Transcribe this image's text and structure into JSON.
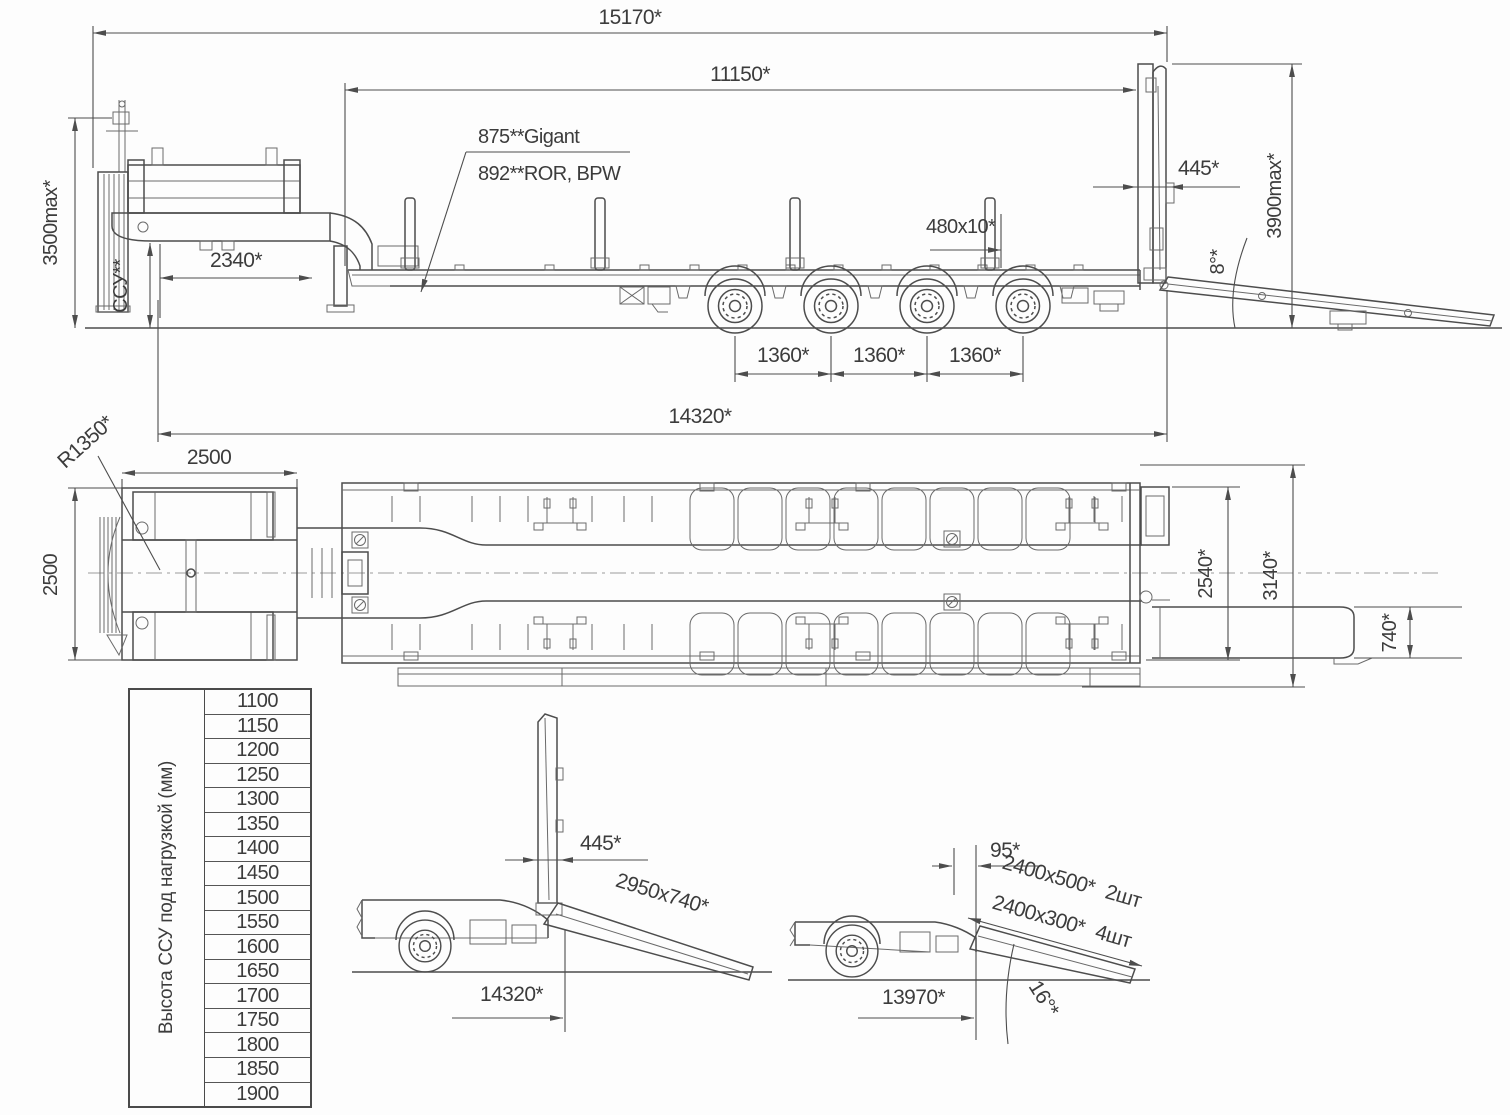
{
  "side_view": {
    "dims": {
      "total_length": "15170*",
      "deck_length": "11150*",
      "deck_height_gigant": "875**Gigant",
      "deck_height_ror": "892**ROR, BPW",
      "gooseneck_length": "2340*",
      "max_height": "3500max*",
      "coupling_height": "ССУ**",
      "rear_plate": "480x10*",
      "flap_width": "445*",
      "rear_max_height": "3900max*",
      "ramp_angle": "8°*",
      "axle_spacing_1": "1360*",
      "axle_spacing_2": "1360*",
      "axle_spacing_3": "1360*",
      "base_length": "14320*"
    }
  },
  "plan_view": {
    "dims": {
      "swing_radius": "R1350*",
      "front_width": "2500",
      "front_width_vertical": "2500",
      "deck_width": "2540*",
      "overall_width": "3140*",
      "ramp_width": "740*"
    }
  },
  "height_table": {
    "header": "Высота ССУ под нагрузкой (мм)",
    "values": [
      "1100",
      "1150",
      "1200",
      "1250",
      "1300",
      "1350",
      "1400",
      "1450",
      "1500",
      "1550",
      "1600",
      "1650",
      "1700",
      "1750",
      "1800",
      "1850",
      "1900"
    ]
  },
  "detail_flap": {
    "dims": {
      "flap_width": "445*",
      "ramp_size": "2950x740*",
      "base_length": "14320*"
    }
  },
  "detail_ramps": {
    "dims": {
      "offset": "95*",
      "ramp_large": "2400x500*",
      "ramp_large_qty": "2шт",
      "ramp_small": "2400x300*",
      "ramp_small_qty": "4шт",
      "length": "13970*",
      "angle": "16°*"
    }
  }
}
